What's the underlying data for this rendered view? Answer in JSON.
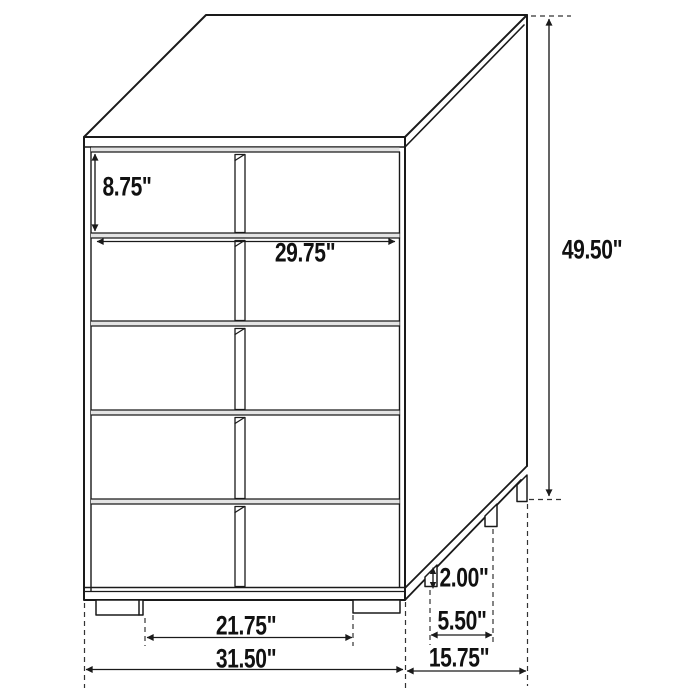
{
  "canvas": {
    "width": 700,
    "height": 700,
    "background": "#ffffff",
    "line_color": "#1a1a1a"
  },
  "diagram": {
    "dimensions": {
      "drawer_height": {
        "label": "8.75\""
      },
      "interior_width": {
        "label": "29.75\""
      },
      "overall_height": {
        "label": "49.50\""
      },
      "leg_height": {
        "label": "2.00\""
      },
      "side_leg_spacing": {
        "label": "5.50\""
      },
      "front_leg_spacing": {
        "label": "21.75\""
      },
      "overall_width": {
        "label": "31.50\""
      },
      "overall_depth": {
        "label": "15.75\""
      }
    }
  }
}
